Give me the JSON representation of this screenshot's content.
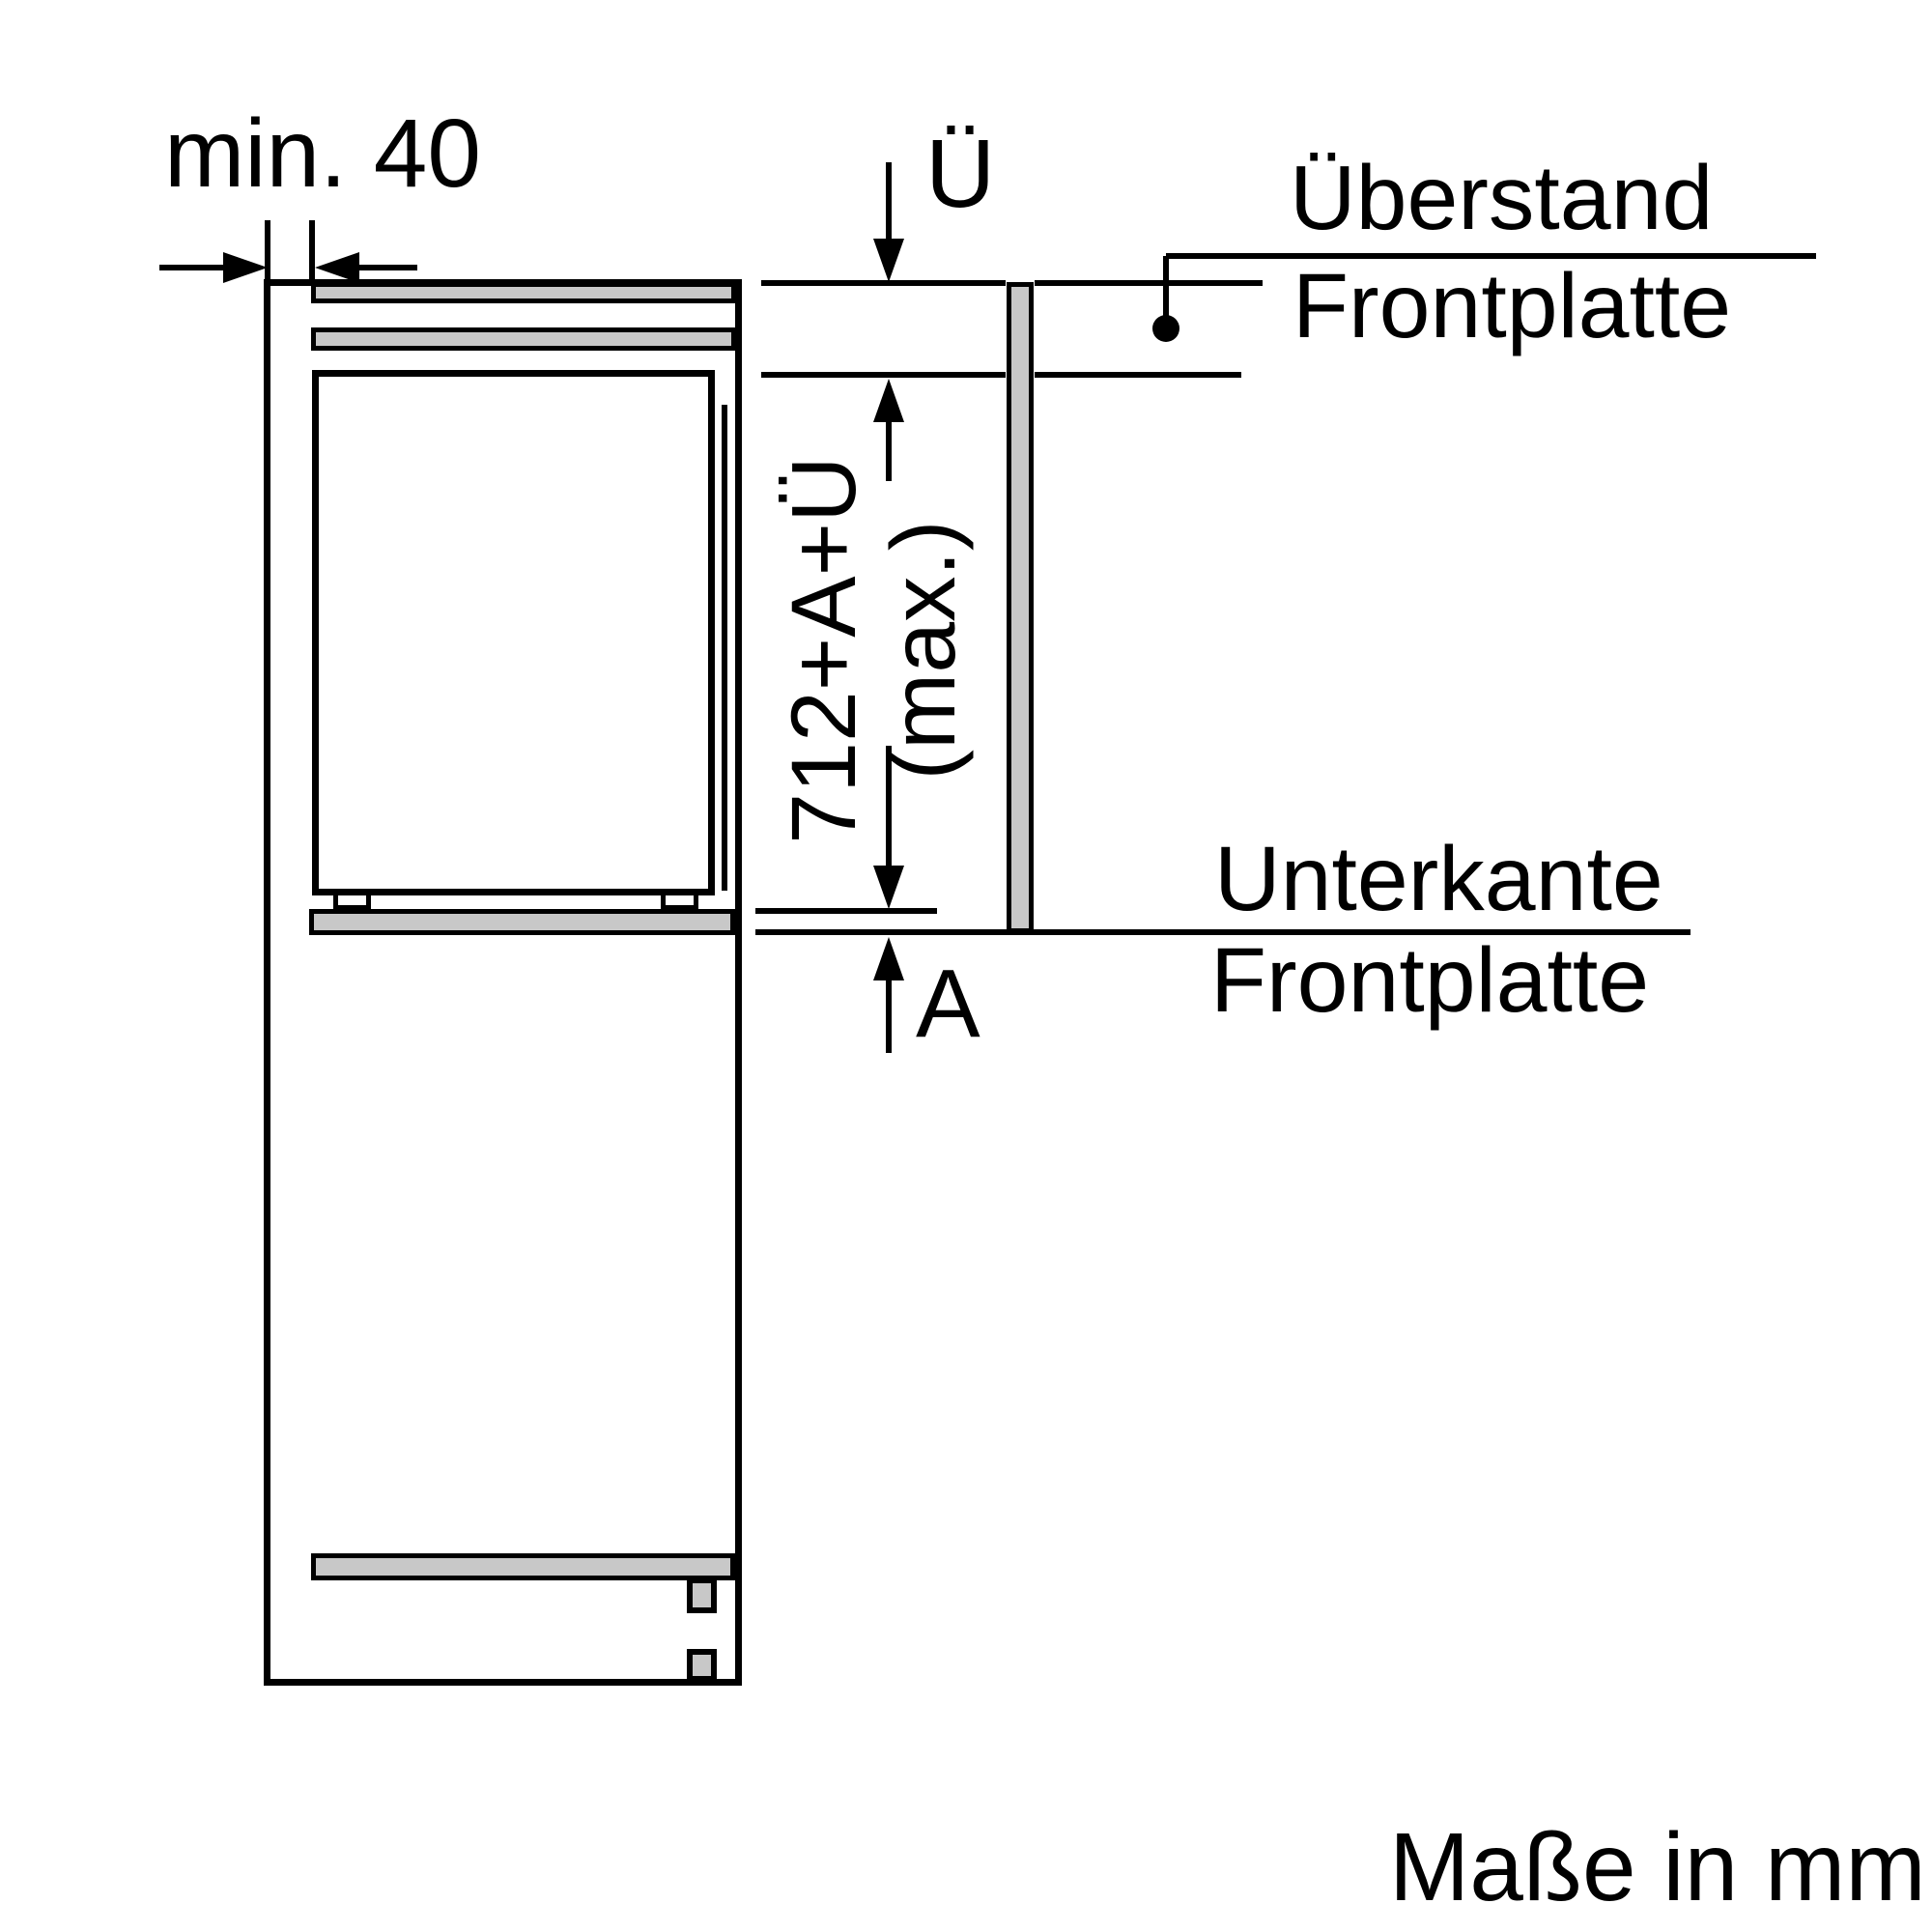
{
  "diagram": {
    "type": "appliance-installation-drawing",
    "units_note": "Maße in mm",
    "colors": {
      "line": "#000000",
      "panel_fill": "#c8c8c8",
      "background": "#ffffff"
    },
    "dimensions": {
      "side_clearance": {
        "label": "min. 40",
        "meaning": "minimum side clearance"
      },
      "overhang": {
        "symbol": "Ü"
      },
      "front_panel_height": {
        "formula": "712+A+Ü",
        "qualifier": "(max.)"
      },
      "bottom_gap": {
        "symbol": "A"
      }
    },
    "annotations": {
      "overhang_label_line1": "Überstand",
      "overhang_label_line2": "Frontplatte",
      "bottom_edge_label_line1": "Unterkante",
      "bottom_edge_label_line2": "Frontplatte"
    }
  }
}
